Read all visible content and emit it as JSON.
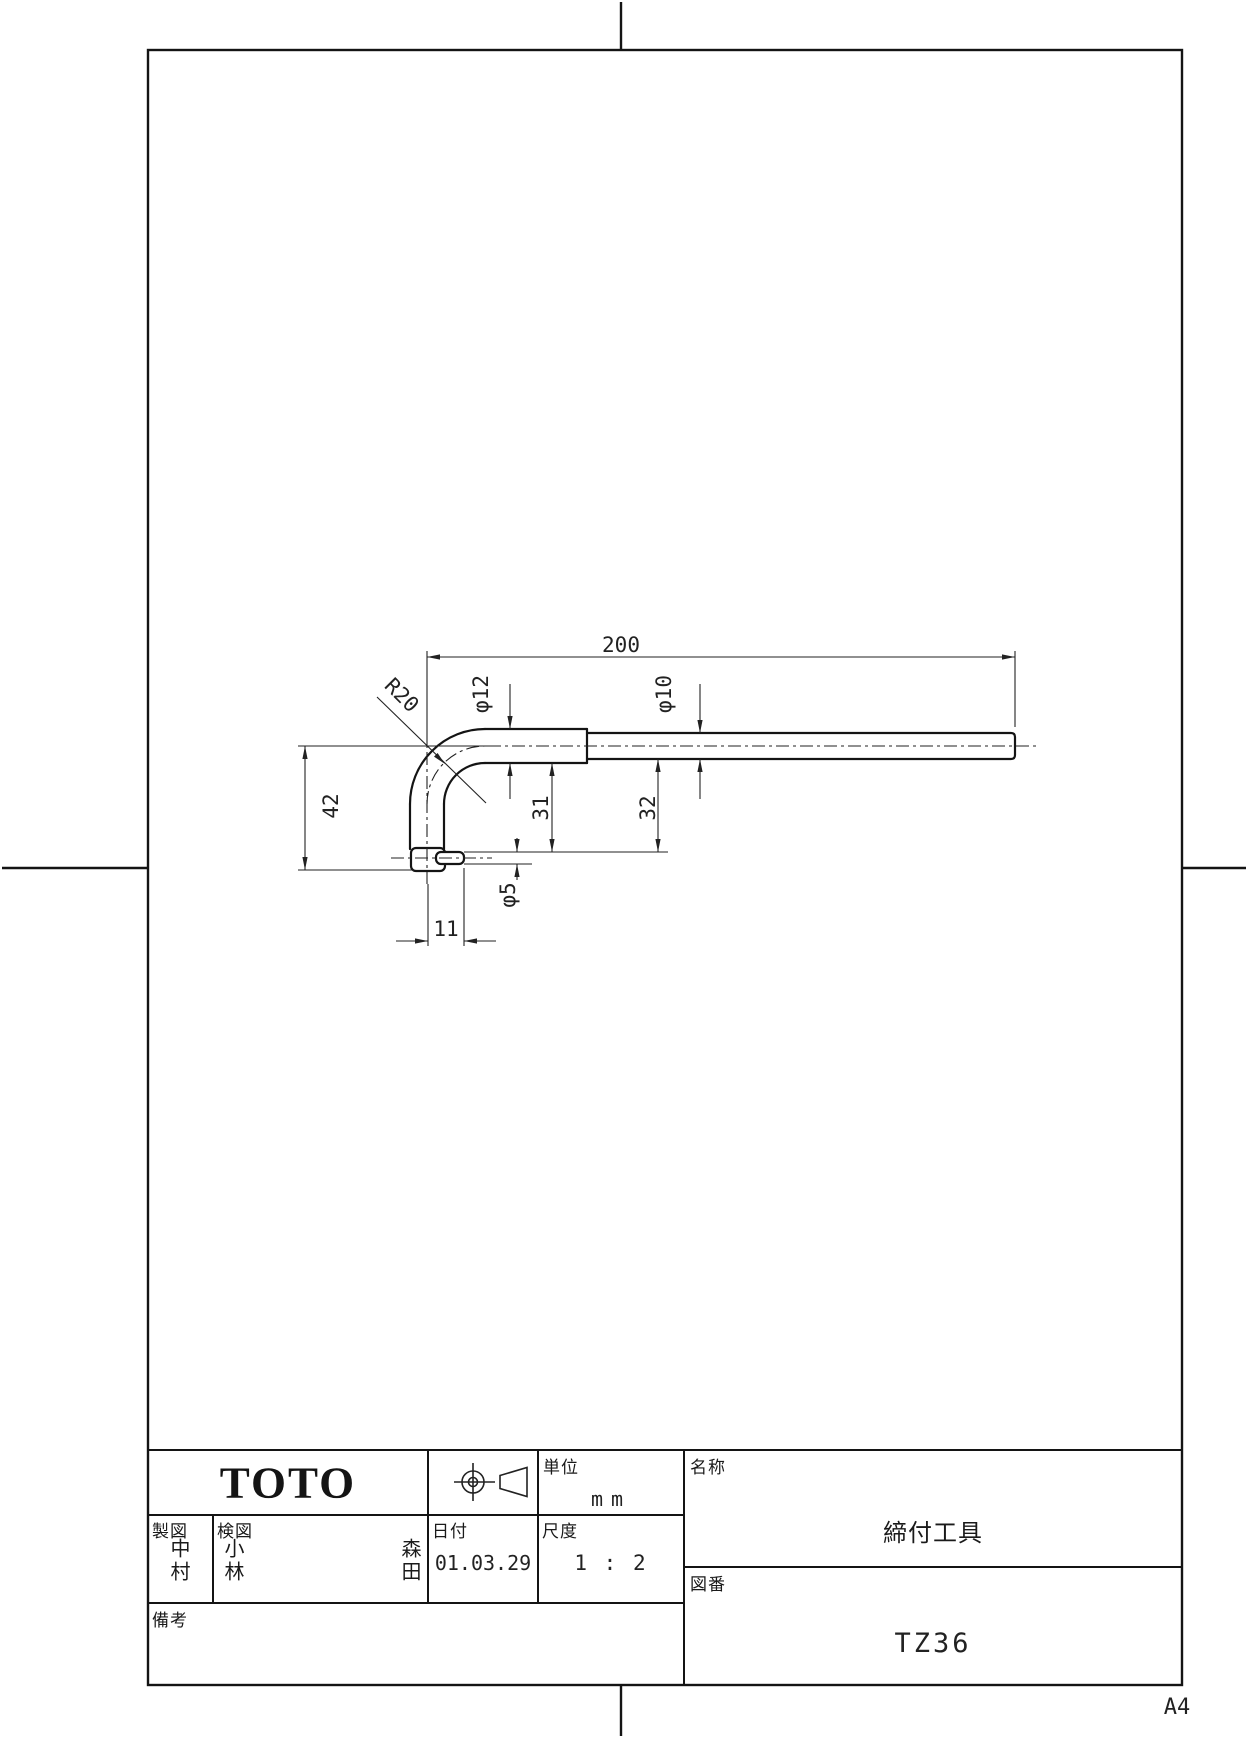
{
  "sheet": {
    "size_label": "A4"
  },
  "dimensions": {
    "length": "200",
    "bend_radius": "R20",
    "dia_shaft_large": "φ12",
    "dia_shaft_small": "φ10",
    "leg_height": "42",
    "dim_31": "31",
    "dim_32": "32",
    "dia_pin": "φ5",
    "pin_offset": "11"
  },
  "title_block": {
    "company": "TOTO",
    "unit_label": "単位",
    "unit_value": "mm",
    "drafter_label": "製図",
    "drafter_value": "中村",
    "checker_label": "検図",
    "checker_value": "小林",
    "approver_value": "森田",
    "date_label": "日付",
    "date_value": "01.03.29",
    "scale_label": "尺度",
    "scale_value": "1 : 2",
    "name_label": "名称",
    "name_value": "締付工具",
    "number_label": "図番",
    "number_value": "TZ36",
    "remarks_label": "備考"
  }
}
